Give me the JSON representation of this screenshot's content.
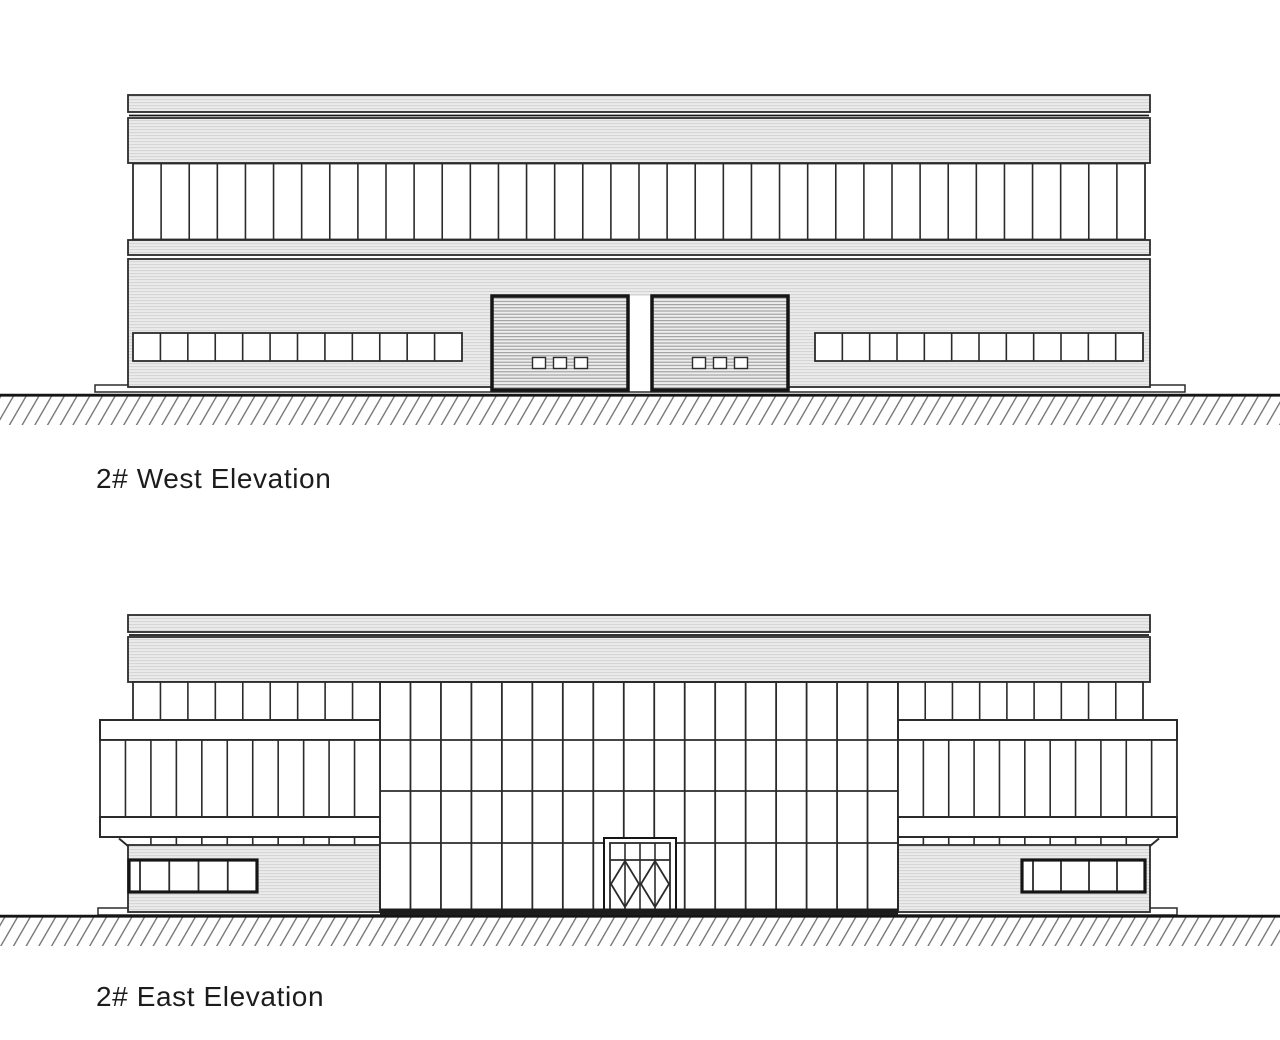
{
  "page": {
    "background": "#ffffff"
  },
  "colors": {
    "line": "#2b2b2b",
    "frame": "#151515",
    "band_fill": "#ebebeb",
    "band_line": "#d3d3d3",
    "door_fill": "#ededed",
    "door_line": "#9c9c9c",
    "ground_line": "#686868",
    "base_bar": "#1c1c1c",
    "text": "#1c1c1c",
    "glass": "#ffffff"
  },
  "drawings": {
    "west": {
      "label": "2# West Elevation",
      "upper_window_panes": 36,
      "lower_window_panes_each_side": 12,
      "roller_doors": 2,
      "door_vision_panels_per_door": 3
    },
    "east": {
      "label": "2# East Elevation",
      "curtain_wall_bays": 17,
      "curtain_wall_transom_rows": 4,
      "clerestory_panes_each_side": 9,
      "wing_window_panes": 11,
      "strip_window_panes": 5,
      "entrance_door_leaves": 2
    }
  }
}
